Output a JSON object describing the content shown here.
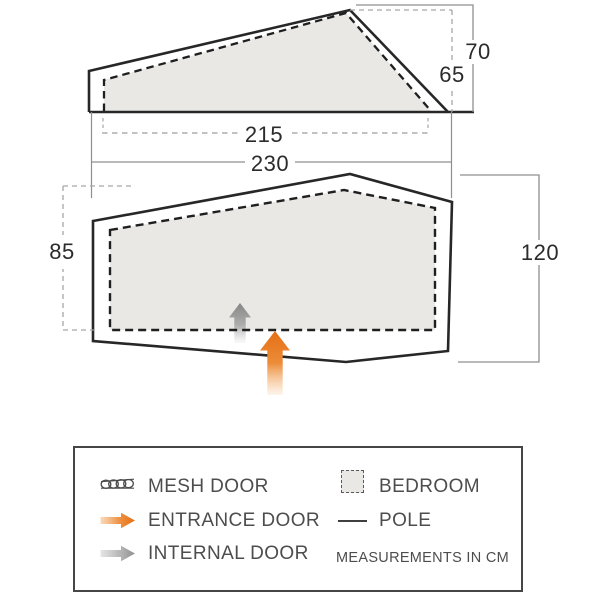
{
  "colors": {
    "outline_dark": "#272727",
    "inner_dash_dark": "#1f1f1f",
    "bedroom_fill": "#e9e8e5",
    "dim_line_gray": "#8f8f8f",
    "dim_dash_gray": "#a6a6a6",
    "accent_orange": "#e8741c",
    "arrow_gray": "#8c8c8c",
    "legend_text": "#4d4d4e",
    "number_text": "#2b2b2b"
  },
  "side_view": {
    "outer_height_cm": "70",
    "inner_height_cm": "65",
    "inner_width_cm": "215",
    "outer_width_cm": "230"
  },
  "floor_plan": {
    "inner_depth_cm": "85",
    "outer_depth_cm": "120"
  },
  "legend": {
    "left_items": [
      {
        "icon": "mesh-door-icon",
        "label": "MESH DOOR"
      },
      {
        "icon": "entrance-door-icon",
        "label": "ENTRANCE DOOR"
      },
      {
        "icon": "internal-door-icon",
        "label": "INTERNAL DOOR"
      }
    ],
    "right_items": [
      {
        "icon": "bedroom-icon",
        "label": "BEDROOM"
      },
      {
        "icon": "pole-icon",
        "label": "POLE"
      }
    ],
    "note": "MEASUREMENTS IN CM"
  }
}
